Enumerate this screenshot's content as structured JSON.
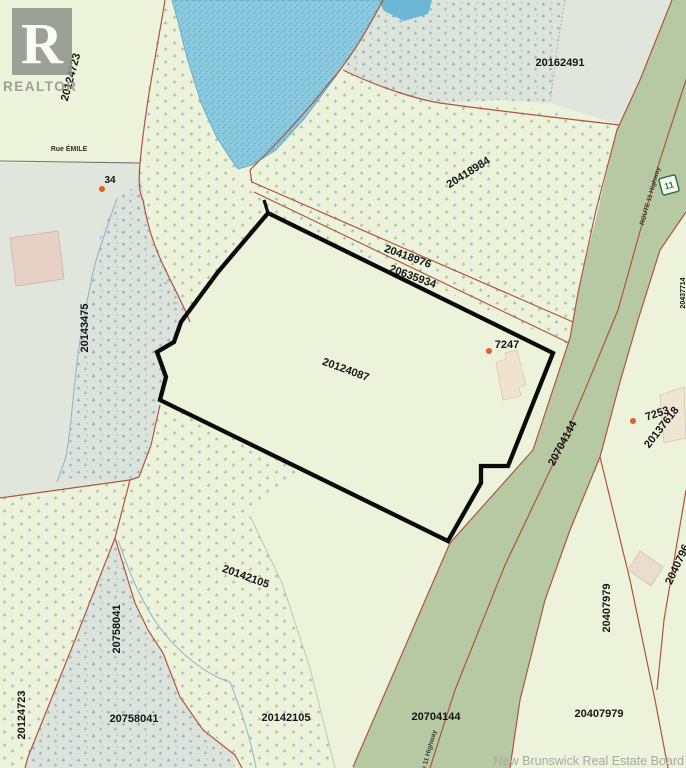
{
  "attribution": "New Brunswick Real Estate Board",
  "logo": {
    "letter": "R",
    "wordmark": "REALTOR"
  },
  "streets": {
    "rue_emile": "Rue ÉMILE"
  },
  "route": {
    "shield_number": "11",
    "name": "ROUTE 11 Highway",
    "name_bottom": "Route 11 Highway"
  },
  "civic_numbers": {
    "n34": "34",
    "n7247": "7247",
    "n7253": "7253"
  },
  "parcels": {
    "p20124723": "20124723",
    "p20162491": "20162491",
    "p20418984": "20418984",
    "p20418976": "20418976",
    "p20635934": "20635934",
    "p20143475": "20143475",
    "p20124087": "20124087",
    "p20137618": "20137618",
    "p20704144": "20704144",
    "p20142105": "20142105",
    "p20758041": "20758041",
    "p20407979": "20407979",
    "p20407961_partial": "2040796",
    "p_right_edge_partial": "20437714"
  },
  "colors": {
    "land": "#edf3da",
    "water": "#8ccadf",
    "grey_parcel": "#e0e6db",
    "marsh": "#dbe3da",
    "highway_band": "#b7c9a2",
    "parcel_line": "#ad5640",
    "subject_boundary": "#0b0b0b",
    "building": "#ead9c6",
    "civic_dot": "#df5f2c",
    "logo_grey": "#8e938a",
    "attribution_grey": "#a7aaa3",
    "route_shield_green": "#2f7c48"
  }
}
